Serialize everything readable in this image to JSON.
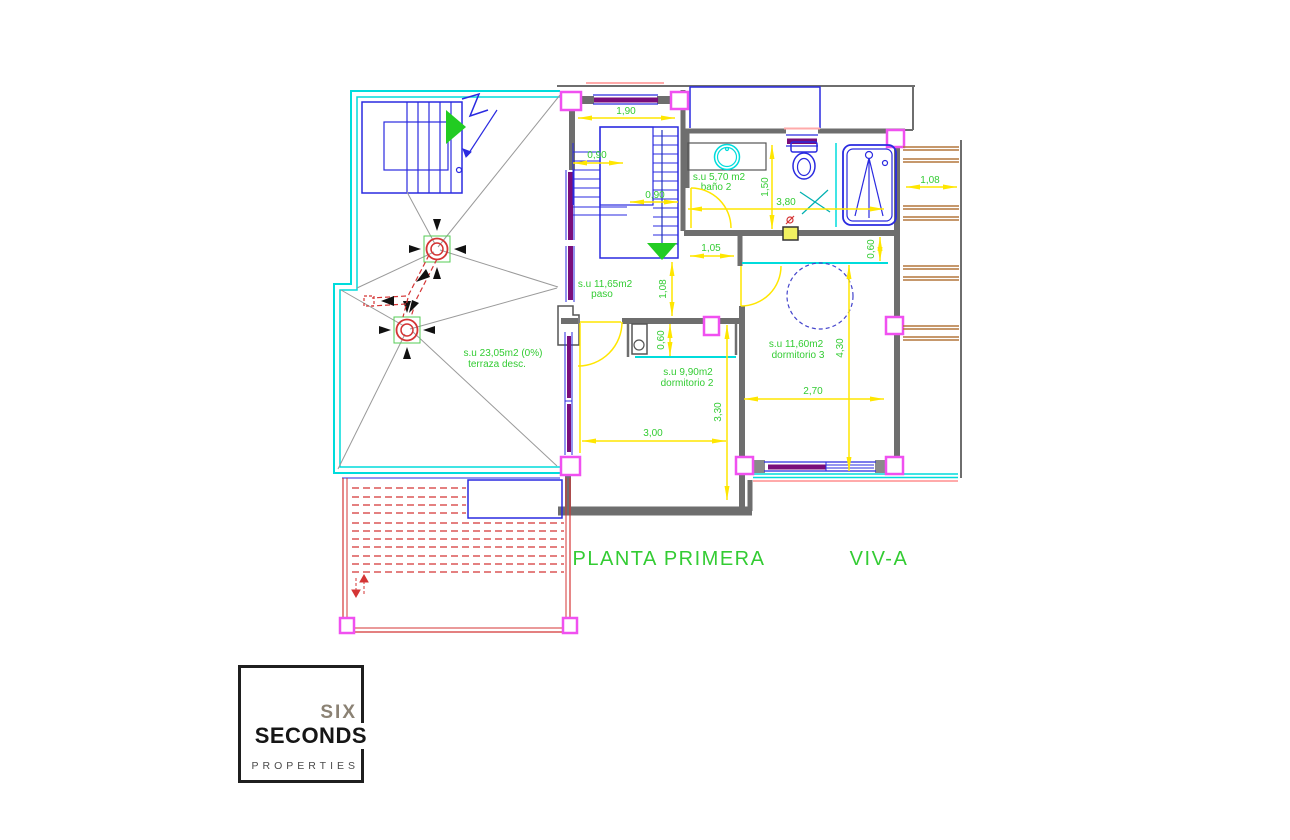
{
  "palette": {
    "wall": "#6e6e6e",
    "slope": "#9a9a9a",
    "cyan": "#00dcdc",
    "blue": "#2a2ae0",
    "magenta": "#f050f0",
    "purple": "#7a0d7a",
    "yellow": "#ffe600",
    "green": "#22cc22",
    "textgreen": "#33cc33",
    "red": "#d43535",
    "salmon": "#ffaaaa",
    "brown": "#b4763c",
    "logodark": "#1f1f1f",
    "logosix": "#8b8274",
    "logoprops": "#4a4a4a"
  },
  "titles": {
    "plan": "PLANTA PRIMERA",
    "unit": "VIV-A"
  },
  "rooms": {
    "terraza": {
      "area": "s.u 23,05m2 (0%)",
      "name": "terraza desc."
    },
    "paso": {
      "area": "s.u 11,65m2",
      "name": "paso"
    },
    "bano2": {
      "area": "s.u 5,70 m2",
      "name": "baño 2"
    },
    "dormitorio2": {
      "area": "s.u 9,90m2",
      "name": "dormitorio 2"
    },
    "dormitorio3": {
      "area": "s.u 11,60m2",
      "name": "dormitorio 3"
    }
  },
  "dims": {
    "stair_width_total": "1,90",
    "stair_flight_upper": "0,90",
    "stair_flight_lower": "0,90",
    "bano2_depth": "1,50",
    "bano2_width": "3,80",
    "pergola_width": "1,08",
    "paso_width": "1,05",
    "paso_length": "1,08",
    "closet_d3_depth": "0,60",
    "closet_d2_depth": "0,60",
    "dorm3_length": "4,30",
    "dorm3_width": "2,70",
    "dorm2_width": "3,00",
    "dorm2_length": "3,30"
  },
  "logo": {
    "line1": "SIX",
    "line2": "SECONDS",
    "line3": "PROPERTIES"
  }
}
